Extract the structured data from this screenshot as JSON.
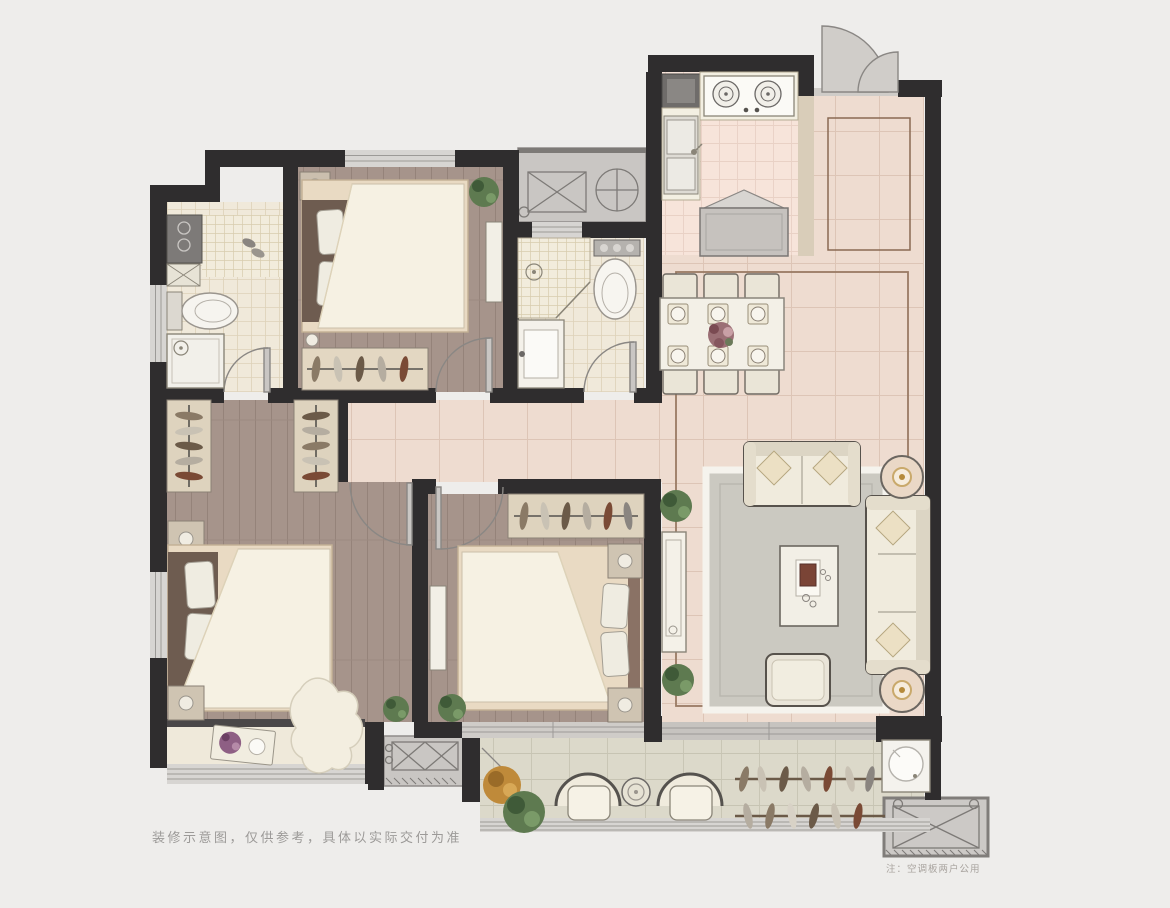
{
  "image_type": "apartment-floor-plan",
  "captions": {
    "disclaimer": "装修示意图，仅供参考，具体以实际交付为准",
    "ac_note": "注：空调板两户公用"
  },
  "colors": {
    "bg": "#eeedeb",
    "wall": "#2f2d2e",
    "wood": "#a6948b",
    "marble": "#eedcd0",
    "tile": "#f0e9da",
    "kitchen": "#f7e4da",
    "balcony": "#dcd9ca",
    "platform": "#c9c6c3",
    "cream": "#f0ebdd",
    "green": "#5e7a50",
    "rug": "#cbc9c1",
    "bedbase": "#e9dac3",
    "headboard": "#6e5c50",
    "border": "#9a7b64",
    "caption": "#9c9a98"
  }
}
